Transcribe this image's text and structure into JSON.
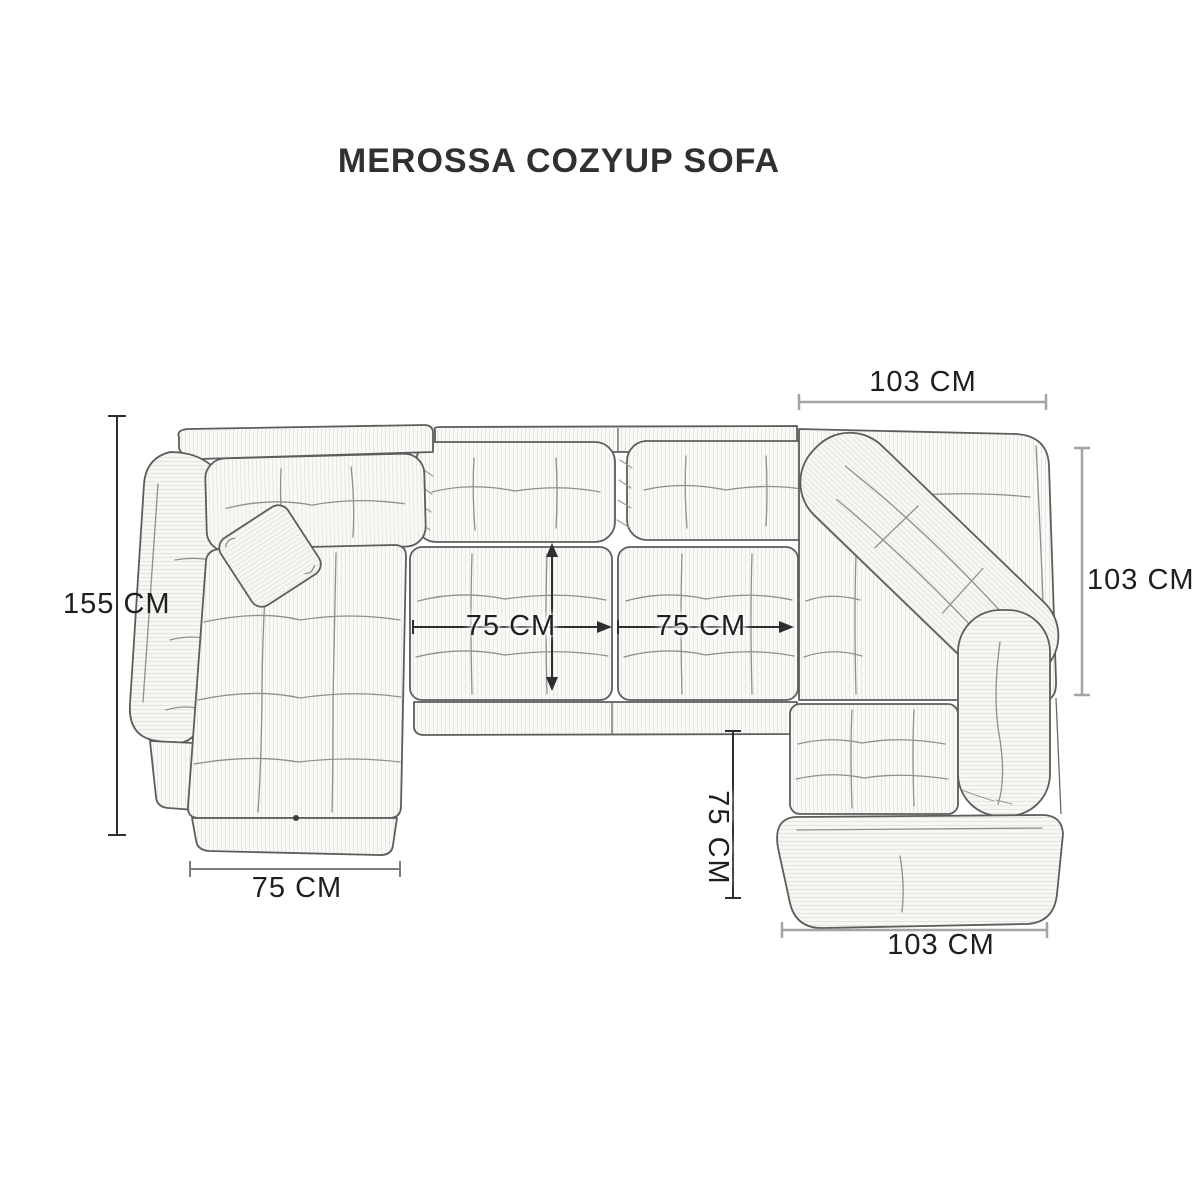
{
  "title": "MEROSSA COZYUP SOFA",
  "diagram": {
    "type": "sofa-top-view-dimension-diagram",
    "dimensions": {
      "left_length": "155 CM",
      "top_width": "103 CM",
      "right_depth": "103 CM",
      "seat1_width": "75 CM",
      "seat2_width": "75 CM",
      "chaise_width": "75 CM",
      "right_seat_depth": "75 CM",
      "bottom_width": "103 CM"
    },
    "colors": {
      "dim_dark": "#2e2e2e",
      "dim_medium": "#7c7c7c",
      "dim_gray": "#a4a4a4",
      "sketch_outline": "#5d5d5d",
      "text": "#1f1f1f",
      "background": "#ffffff"
    }
  }
}
